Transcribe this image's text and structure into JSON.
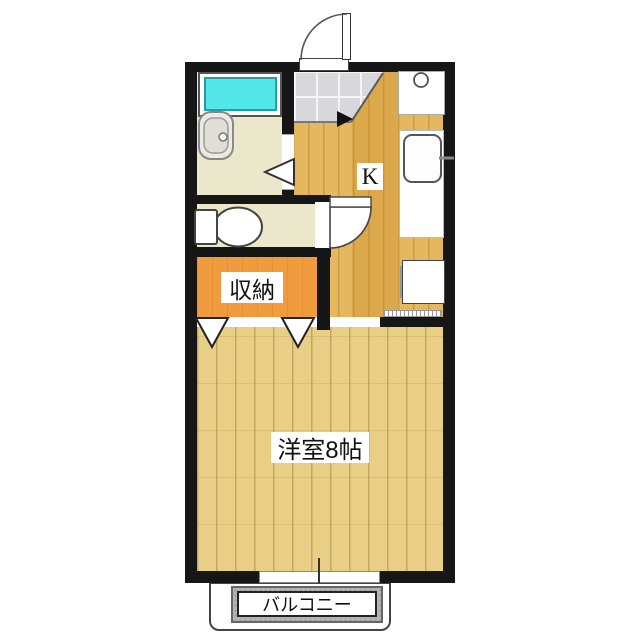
{
  "floorplan": {
    "type": "japanese-apartment-1K",
    "labels": {
      "kitchen": "K",
      "closet": "収納",
      "western_room": "洋室8帖",
      "balcony": "バルコニー"
    },
    "rooms": [
      {
        "name": "kitchen",
        "label": "K"
      },
      {
        "name": "western-room",
        "label": "洋室8帖",
        "size_tatami": 8
      },
      {
        "name": "closet",
        "label": "収納"
      },
      {
        "name": "balcony",
        "label": "バルコニー"
      },
      {
        "name": "bathroom",
        "label": ""
      },
      {
        "name": "toilet",
        "label": ""
      },
      {
        "name": "entrance-genkan",
        "label": ""
      }
    ],
    "fixtures": [
      "entrance-door",
      "genkan-tile",
      "bathtub",
      "washbasin",
      "toilet-bowl",
      "bathroom-folding-door",
      "toilet-door",
      "stove-burner",
      "kitchen-sink",
      "faucet",
      "refrigerator-space",
      "closet-folding-doors",
      "sliding-window",
      "balcony-rail"
    ],
    "colors": {
      "wall": "#161616",
      "kitchen_floor": "#e5b75f",
      "room_floor": "#e9cf85",
      "closet_floor": "#ef9b3e",
      "wet_area_floor": "#ebe7ca",
      "entrance_tile": "#d8d8dc",
      "bathtub": "#53e8e8",
      "balcony_floor": "#b4b4b4",
      "fixture_white": "#ffffff"
    }
  }
}
